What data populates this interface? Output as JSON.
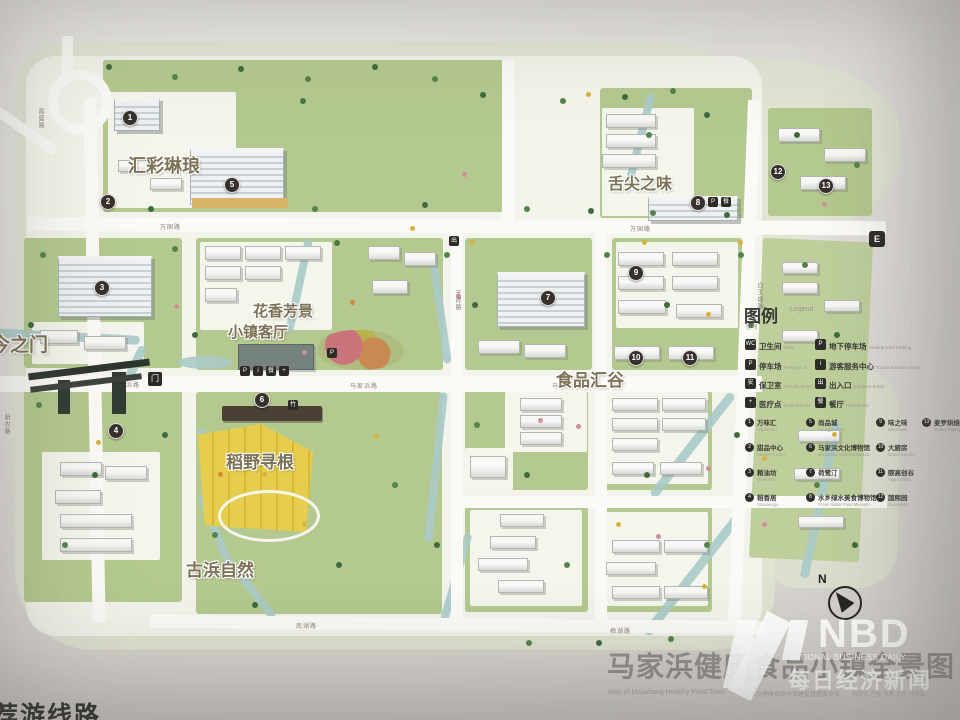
{
  "colors": {
    "paper": "#e4e2dd",
    "parcel_green": "#b4c98f",
    "road_white": "#fbfaf6",
    "water": "#a8cac8",
    "field_yellow": "#e5cb49",
    "marker": "#38302a",
    "zone_label": "#7d7257"
  },
  "zones": {
    "huicai": "汇彩琳琅",
    "huaxiang": "花香芳景",
    "keting": "小镇客厅",
    "shipin": "食品汇谷",
    "shejian": "舌尖之味",
    "daoye": "稻野寻根",
    "gubang": "古浜自然",
    "gate": "古今之门"
  },
  "roads": [
    {
      "label": "万国路"
    },
    {
      "label": "万国路"
    },
    {
      "label": "马家浜路"
    },
    {
      "label": "马家浜路"
    },
    {
      "label": "马家浜路"
    },
    {
      "label": "天祥路"
    },
    {
      "label": "白玉塘路"
    },
    {
      "label": "南湖路"
    },
    {
      "label": "梅湖路"
    },
    {
      "label": "昌盛路"
    },
    {
      "label": "新农路"
    }
  ],
  "badges": {
    "e": "E",
    "exit": "出",
    "p": "P",
    "info": "i",
    "food": "餐",
    "plus": "+",
    "bamboo": "竹",
    "gate": "门"
  },
  "legend": {
    "title": "图例",
    "title_en": "Legend",
    "title_sub": "범례",
    "facilities": [
      {
        "glyph": "WC",
        "cn": "卫生间",
        "en": "Toilet"
      },
      {
        "glyph": "P",
        "cn": "地下停车场",
        "en": "Underground Parking"
      },
      {
        "glyph": "P",
        "cn": "停车场",
        "en": "Parking Lot"
      },
      {
        "glyph": "i",
        "cn": "游客服务中心",
        "en": "Tourist Service Center"
      },
      {
        "glyph": "安",
        "cn": "保卫室",
        "en": "Security Room"
      },
      {
        "glyph": "出",
        "cn": "出入口",
        "en": "Entrance & Exit"
      },
      {
        "glyph": "+",
        "cn": "医疗点",
        "en": "Medical Point"
      },
      {
        "glyph": "餐",
        "cn": "餐厅",
        "en": "Restaurant"
      }
    ],
    "places": [
      {
        "n": "1",
        "name": "万味汇",
        "en": "Wanweihui"
      },
      {
        "n": "2",
        "name": "甜品中心",
        "en": "Dessert Center"
      },
      {
        "n": "3",
        "name": "粮油坊",
        "en": "Grain Mill"
      },
      {
        "n": "4",
        "name": "稻香居",
        "en": "Daoxiangju"
      },
      {
        "n": "5",
        "name": "尚品城",
        "en": "Shangpin City"
      },
      {
        "n": "6",
        "name": "马家浜文化博物馆",
        "en": "Majiabang Culture Museum"
      },
      {
        "n": "7",
        "name": "荷鹭汀",
        "en": "Heluting"
      },
      {
        "n": "8",
        "name": "水乡绿水美食博物馆",
        "en": "Green Water Food Museum"
      },
      {
        "n": "9",
        "name": "味之味",
        "en": "Weizhiwei"
      },
      {
        "n": "10",
        "name": "大厨房",
        "en": "Grand Kitchen"
      },
      {
        "n": "11",
        "name": "颐高创谷",
        "en": "Yigao Valley"
      },
      {
        "n": "12",
        "name": "国熙园",
        "en": "Guoxiyuan"
      },
      {
        "n": "13",
        "name": "麦罗烘焙",
        "en": "Mailuo Bakery"
      }
    ]
  },
  "compass": {
    "n": "N"
  },
  "corner": {
    "text": "推荐游线路"
  },
  "footer": {
    "title": "马家浜健康食品小镇全景图",
    "subtitle_en": "Map of Majiabang Healthy Food Town",
    "subtitle_cn": "马家浜健康食品小镇建设管理委员会",
    "subtitle_kr": "마자방 건강 식품 소진 전경도"
  },
  "watermark": {
    "brand": "NBD",
    "tagline": "NATIONAL BUSINESS DAILY",
    "brand_cn": "每日经济新闻"
  }
}
